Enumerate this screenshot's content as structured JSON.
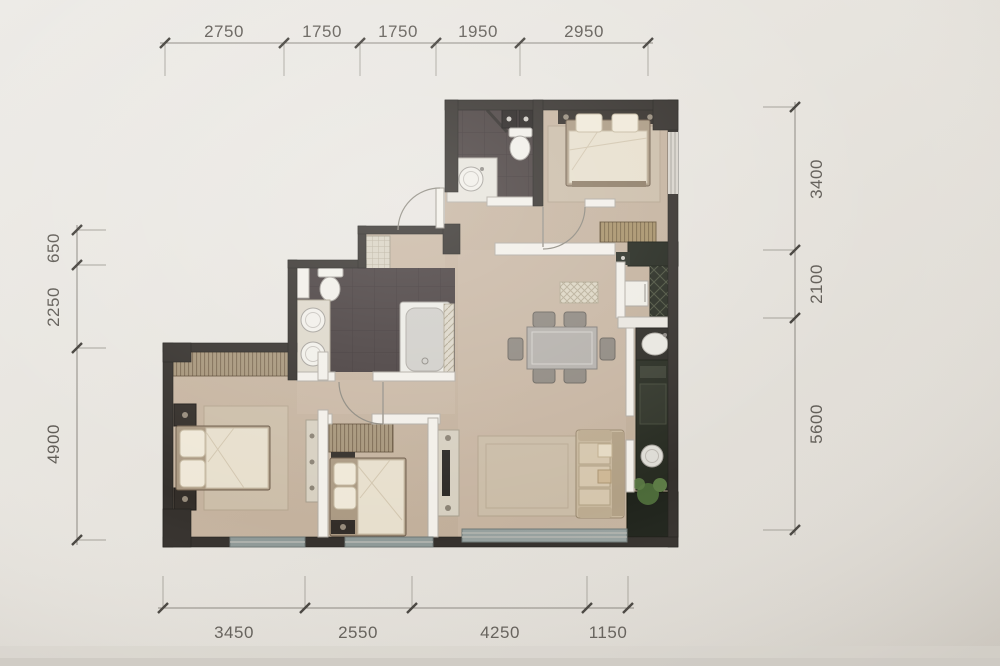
{
  "document": {
    "type": "apartment-floor-plan",
    "units": "mm"
  },
  "dimensions": {
    "top": [
      "2750",
      "1750",
      "1750",
      "1950",
      "2950"
    ],
    "bottom": [
      "3450",
      "2550",
      "4250",
      "1150"
    ],
    "left": [
      "650",
      "2250",
      "4900"
    ],
    "right": [
      "3400",
      "2100",
      "5600"
    ]
  },
  "colors": {
    "paper": "#e8e5df",
    "wall_dark": "#34302c",
    "wall_light": "#f2efe9",
    "floor_wood": "#c6b4a0",
    "bath_tile": "#463d3d",
    "counter_red": "#6e3124",
    "kitchen_counter": "#22261d",
    "window_glass": "#96a09e",
    "plant_green": "#4f6d3b",
    "dimension_text": "#615d57"
  },
  "fixtures": [
    "double-bed-master",
    "double-bed-west",
    "single-bed-middle",
    "wardrobe-striped",
    "closet-striped",
    "dresser-striped",
    "dining-table",
    "dining-chairs-x6",
    "sofa",
    "tv-console",
    "rug",
    "bathtub",
    "toilet-x2",
    "round-basin",
    "double-vanity",
    "shoe-cabinet",
    "refrigerator",
    "stove",
    "kitchen-sink-x2",
    "doormat",
    "plant",
    "entry-door",
    "interior-door-arcs",
    "windows"
  ]
}
